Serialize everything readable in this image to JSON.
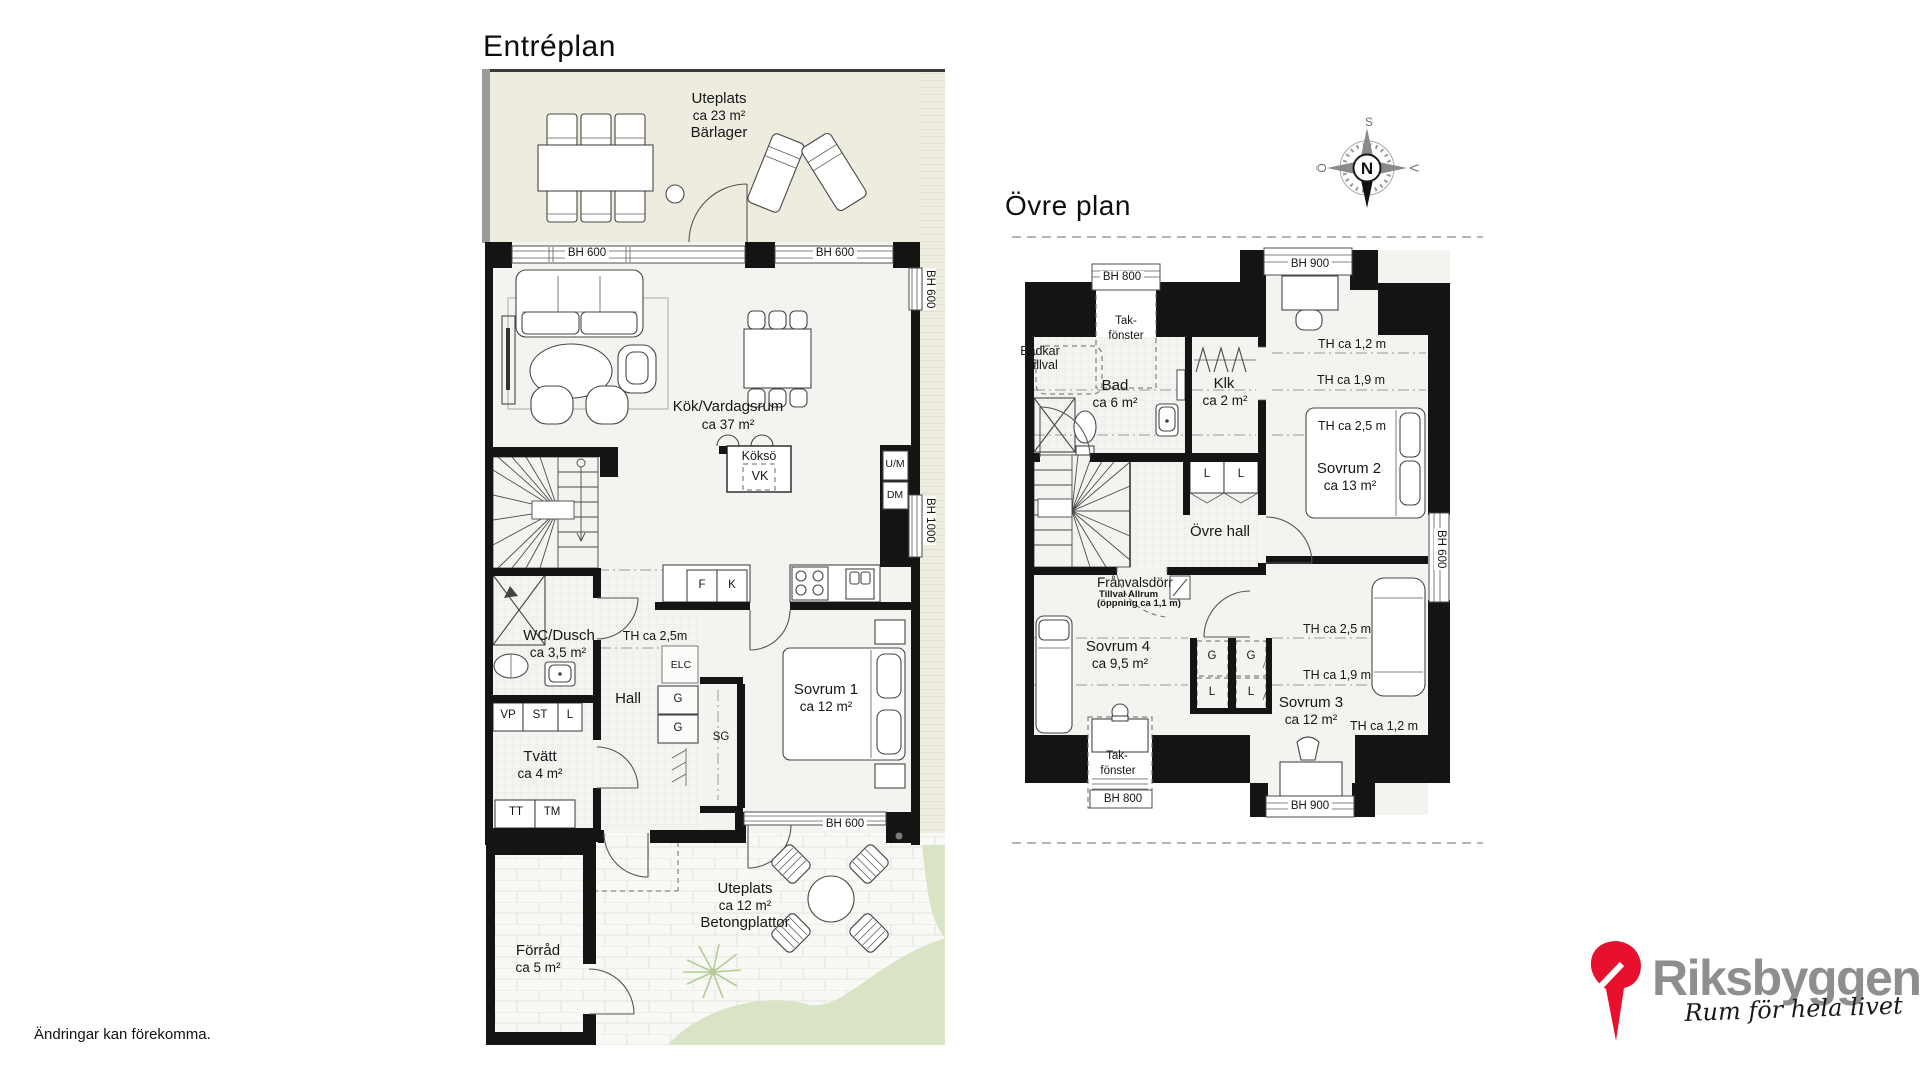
{
  "entreplan": {
    "title": "Entréplan",
    "terrace_top": {
      "name": "Uteplats",
      "area": "ca 23 m²",
      "surface": "Bärlager"
    },
    "terrace_bottom": {
      "name": "Uteplats",
      "area": "ca 12 m²",
      "surface": "Betongplattor"
    },
    "windows": {
      "w1": "BH 600",
      "w2": "BH 600",
      "right_upper": "BH 600",
      "right_lower": "BH 1000",
      "bedroom": "BH 600"
    },
    "kitchen": {
      "name": "Kök/Vardagsrum",
      "area": "ca 37 m²",
      "island": "Köksö",
      "hob": "VK",
      "fridge": "F",
      "freezer": "K",
      "oven_micro": "U/M",
      "dishwasher": "DM"
    },
    "wc": {
      "name": "WC/Dusch",
      "area": "ca 3,5 m²"
    },
    "hall": {
      "name": "Hall",
      "elc": "ELC",
      "g1": "G",
      "g2": "G",
      "sg": "SG",
      "th": "TH ca 2,5m"
    },
    "bedroom1": {
      "name": "Sovrum 1",
      "area": "ca 12 m²"
    },
    "laundry": {
      "name": "Tvätt",
      "area": "ca 4 m²",
      "vp": "VP",
      "st": "ST",
      "l": "L",
      "tt": "TT",
      "tm": "TM"
    },
    "storage": {
      "name": "Förråd",
      "area": "ca 5 m²"
    }
  },
  "ovreplan": {
    "title": "Övre plan",
    "windows": {
      "top_left": "BH 800",
      "top_right": "BH 900",
      "right": "BH 600",
      "bottom_left": "BH 800",
      "bottom_right": "BH 900"
    },
    "skylight_top": {
      "l1": "Tak-",
      "l2": "fönster"
    },
    "skylight_bottom": {
      "l1": "Tak-",
      "l2": "fönster"
    },
    "bath": {
      "name": "Bad",
      "area": "ca 6 m²",
      "opt1": "Badkar",
      "opt2": "Tillval"
    },
    "klk": {
      "name": "Klk",
      "area": "ca 2 m²"
    },
    "hall": {
      "name": "Övre hall",
      "l1": "L",
      "l2": "L"
    },
    "optdoor": {
      "l1": "Frånvalsdörr",
      "l2": "Tillval Allrum",
      "l3": "(öppning ca 1,1 m)"
    },
    "bedroom2": {
      "name": "Sovrum 2",
      "area": "ca 13 m²",
      "th12": "TH ca 1,2 m",
      "th19": "TH ca 1,9 m",
      "th25": "TH ca 2,5 m"
    },
    "bedroom3": {
      "name": "Sovrum 3",
      "area": "ca 12 m²",
      "th25": "TH ca 2,5 m",
      "th19": "TH ca 1,9 m",
      "th12": "TH ca 1,2 m"
    },
    "bedroom4": {
      "name": "Sovrum 4",
      "area": "ca 9,5 m²"
    },
    "closets": {
      "g1": "G",
      "g2": "G",
      "l1": "L",
      "l2": "L"
    }
  },
  "compass": {
    "n": "N",
    "s": "S",
    "e": "Ö",
    "w": "V"
  },
  "footer": {
    "disclaimer": "Ändringar kan förekomma."
  },
  "brand": {
    "name": "Riksbyggen",
    "tagline": "Rum för hela livet"
  },
  "colors": {
    "terrace": "#edecdf",
    "grass": "#d8e4c4",
    "wall": "#141414",
    "floor": "#f3f3f0",
    "brand_red": "#e8112d",
    "brand_gray": "#8e8e8e"
  }
}
